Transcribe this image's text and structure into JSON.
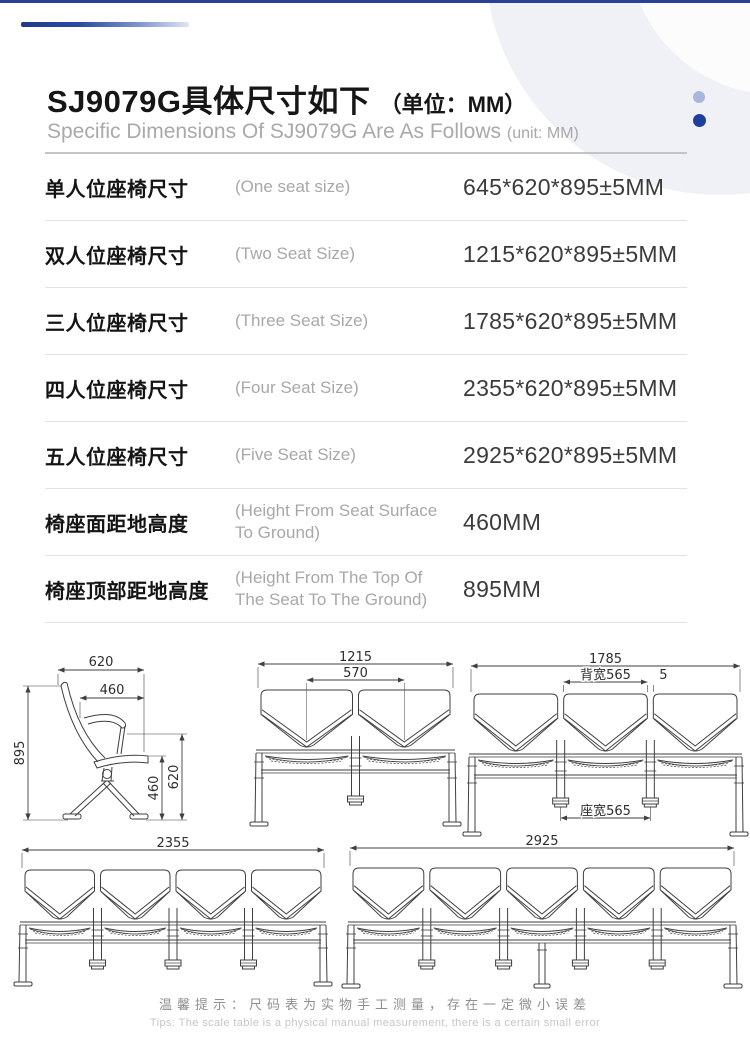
{
  "header": {
    "title_cn": "SJ9079G具体尺寸如下",
    "title_unit": "（单位：MM）",
    "subtitle_en": "Specific Dimensions Of SJ9079G Are As Follows",
    "subtitle_unit": "(unit: MM)"
  },
  "spec_table": {
    "rows": [
      {
        "label_cn": "单人位座椅尺寸",
        "label_en": "(One seat size)",
        "value": "645*620*895±5MM"
      },
      {
        "label_cn": "双人位座椅尺寸",
        "label_en": "(Two Seat Size)",
        "value": "1215*620*895±5MM"
      },
      {
        "label_cn": "三人位座椅尺寸",
        "label_en": "(Three Seat Size)",
        "value": "1785*620*895±5MM"
      },
      {
        "label_cn": "四人位座椅尺寸",
        "label_en": "(Four Seat Size)",
        "value": "2355*620*895±5MM"
      },
      {
        "label_cn": "五人位座椅尺寸",
        "label_en": "(Five Seat Size)",
        "value": "460MM",
        "value_note": "",
        "value_real": "2925*620*895±5MM"
      },
      {
        "label_cn": "椅座面距地高度",
        "label_en": "(Height From Seat Surface To Ground)",
        "value": "460MM"
      },
      {
        "label_cn": "椅座顶部距地高度",
        "label_en": "(Height From The Top Of The Seat To The Ground)",
        "value": "895MM"
      }
    ]
  },
  "drawings": {
    "side_view": {
      "top_width": "620",
      "seat_depth": "460",
      "total_height": "895",
      "seat_height": "460",
      "back_height": "620"
    },
    "bench2": {
      "seats": 2,
      "total": "1215",
      "inner": "570"
    },
    "bench3": {
      "seats": 3,
      "total": "1785",
      "back_width": "背宽565",
      "gap": "5",
      "seat_width": "座宽565"
    },
    "bench4": {
      "seats": 4,
      "total": "2355"
    },
    "bench5": {
      "seats": 5,
      "total": "2925",
      "center_leg": true
    }
  },
  "footer": {
    "tip_cn": "温馨提示：尺码表为实物手工测量，存在一定微小误差",
    "tip_en": "Tips: The scale table is a physical manual measurement, there is a certain small error"
  },
  "colors": {
    "accent_navy": "#24409a",
    "dot_dark": "#1e3f9d",
    "dot_light": "#aab7dc",
    "drawing_stroke": "#3f3f3f"
  }
}
